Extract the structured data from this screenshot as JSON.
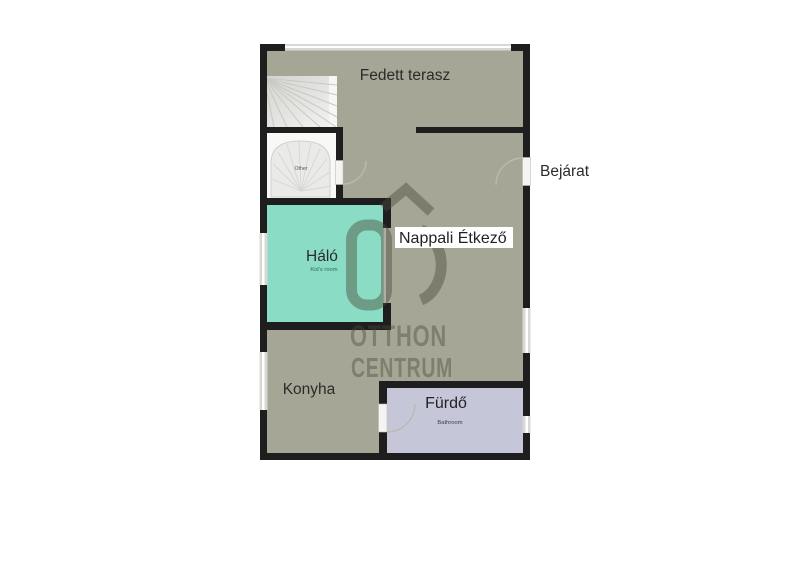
{
  "floorplan": {
    "floor_color": "#a5a695",
    "wall_color": "#1e1e1e",
    "rooms": {
      "terrace": {
        "label": "Fedett terasz"
      },
      "living_dining": {
        "label": "Nappali Étkező"
      },
      "bedroom": {
        "label": "Háló",
        "sublabel": "Kid's room",
        "color": "#8adcc5",
        "sublabel_color": "#2f6b5d"
      },
      "kitchen": {
        "label": "Konyha"
      },
      "bathroom": {
        "label": "Fürdő",
        "sublabel": "Bathroom",
        "color": "#c6c6d9",
        "sublabel_color": "#3c3c52"
      },
      "stair_room": {
        "label": "Other"
      }
    },
    "entrance_label": "Bejárat",
    "watermark": {
      "line1": "OTTHON",
      "line2": "CENTRUM",
      "color": "#4b4b3a"
    }
  }
}
